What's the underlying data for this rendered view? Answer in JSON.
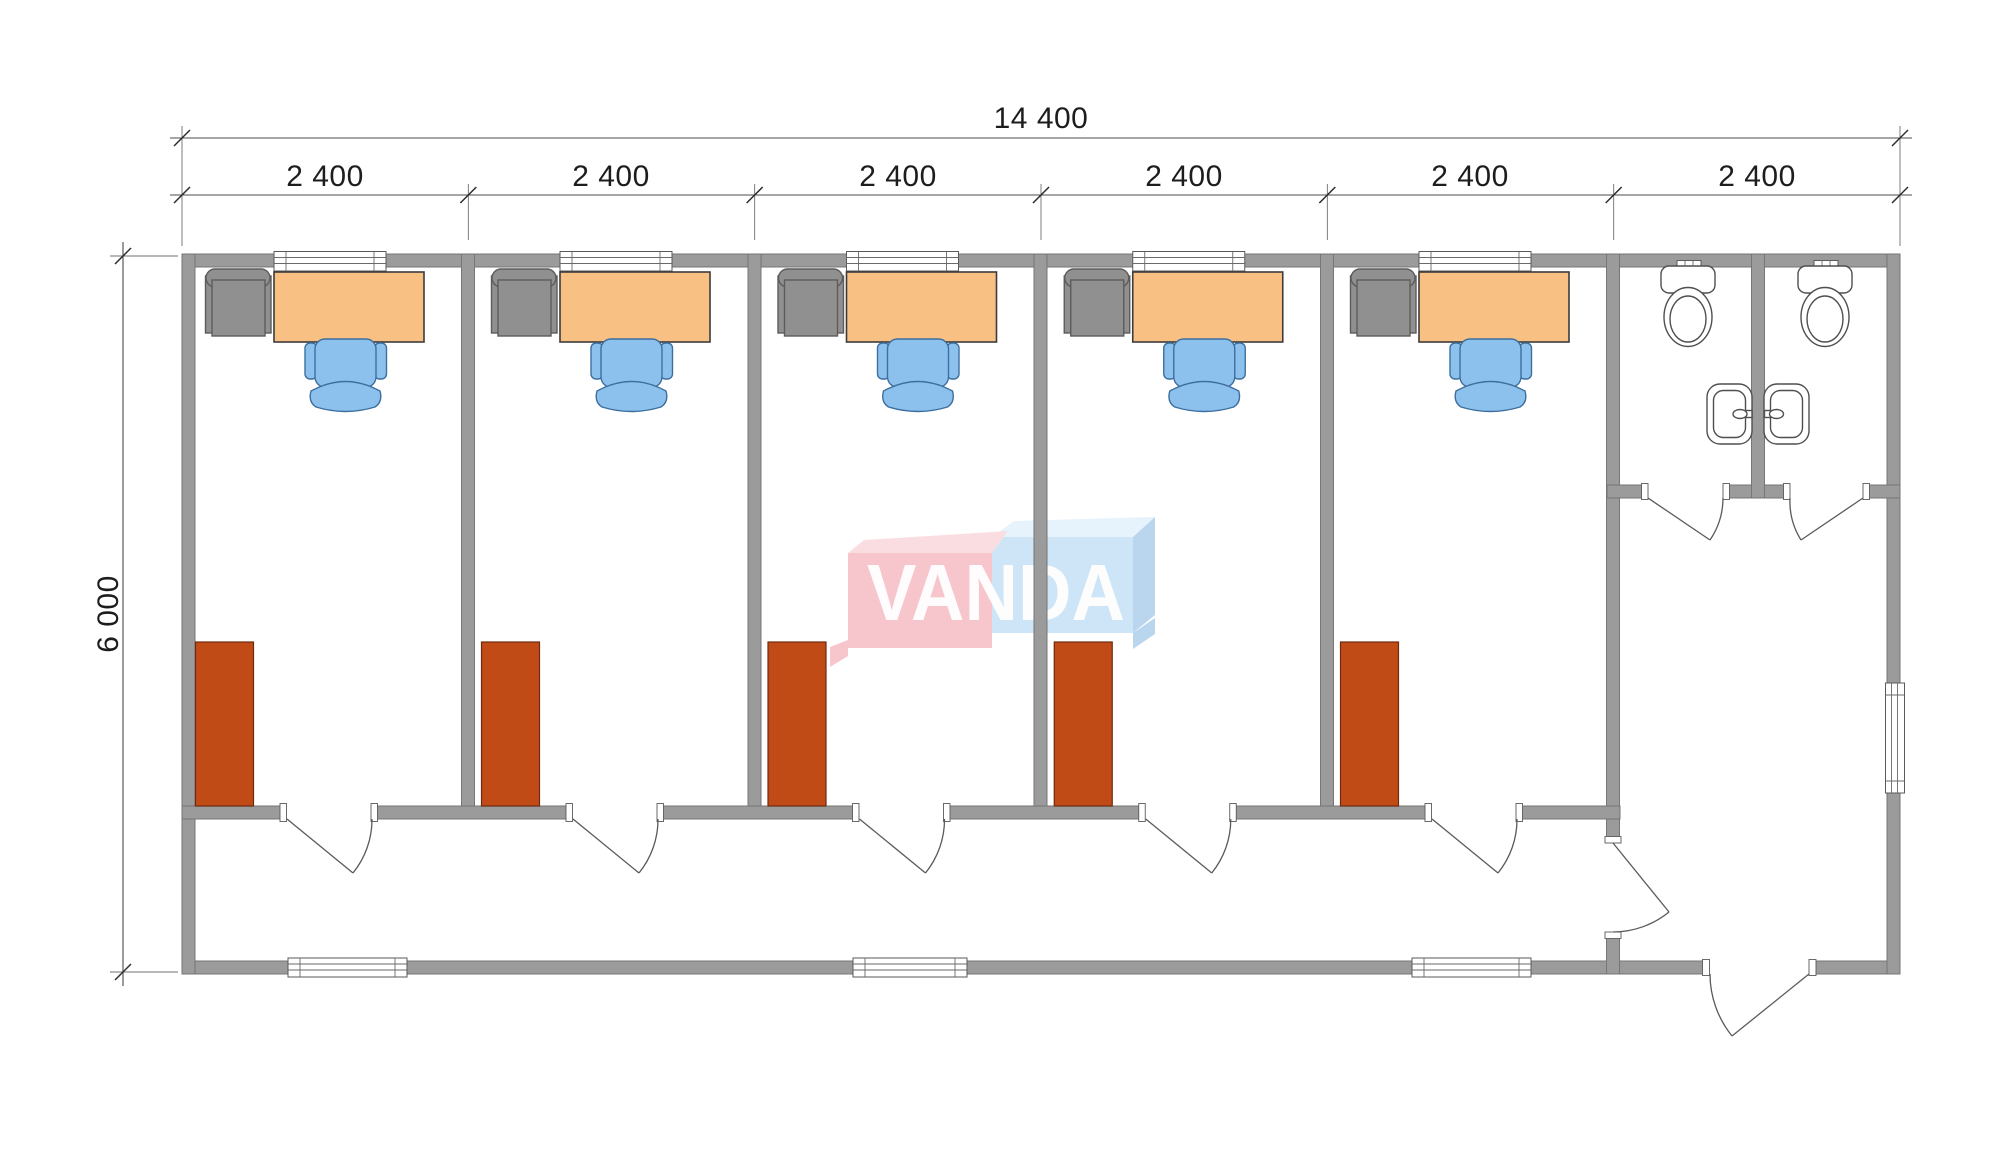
{
  "dimensions": {
    "overall_width": "14 400",
    "bay_widths": [
      "2 400",
      "2 400",
      "2 400",
      "2 400",
      "2 400",
      "2 400"
    ],
    "overall_depth": "6 000"
  },
  "watermark": {
    "text": "VANDA"
  },
  "drawing": {
    "office_bays": 5,
    "office_furniture": [
      "desk",
      "office-chair",
      "armchair",
      "wardrobe"
    ],
    "sanitary": {
      "wc_stalls": 2,
      "toilets": 2,
      "washbasins": 2
    },
    "openings": {
      "office_windows": 5,
      "facade_windows": 3,
      "side_window": 1,
      "office_doors": 5,
      "wc_doors": 2,
      "lobby_door": 1,
      "entrance_door": 1
    }
  },
  "colors": {
    "wall": "#9b9b9b",
    "desk": "#f9c083",
    "office_chair": "#8cc1ee",
    "armchair": "#909090",
    "wardrobe": "#c14b16",
    "logo_pink_front": "#f6c6cc",
    "logo_pink_top": "#fadde1",
    "logo_blue_front": "#cde5f7",
    "logo_blue_top": "#e6f2fc",
    "logo_blue_side": "#b9d6ee"
  }
}
